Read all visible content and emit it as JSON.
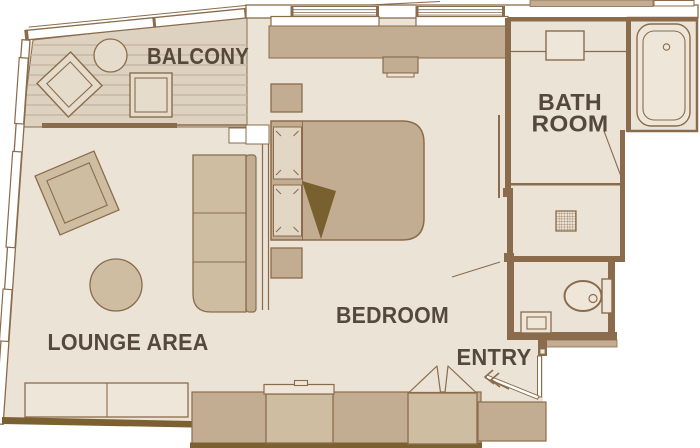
{
  "title": "Suite floor plan",
  "labels": {
    "balcony": "BALCONY",
    "bath_line1": "BATH",
    "bath_line2": "ROOM",
    "bedroom": "BEDROOM",
    "lounge": "LOUNGE AREA",
    "entry": "ENTRY"
  },
  "rooms": [
    {
      "id": "balcony",
      "label": "BALCONY"
    },
    {
      "id": "bathroom",
      "label": "BATH ROOM"
    },
    {
      "id": "bedroom",
      "label": "BEDROOM"
    },
    {
      "id": "lounge",
      "label": "LOUNGE AREA"
    },
    {
      "id": "entry",
      "label": "ENTRY"
    }
  ],
  "palette": {
    "bg": "#ffffff",
    "floor": "#ebe3d6",
    "balcony_floor": "#ddd2c0",
    "plank_line": "#c6b8a2",
    "tan": "#c3ad92",
    "furniture": "#cfbda2",
    "balcony_furniture": "#e6dccb",
    "fixture": "#eee6d9",
    "pillow": "#e2d7c4",
    "outline": "#8a6c4c",
    "dark_edge": "#7b6132",
    "blanket": "#79602f",
    "ink": "#55493c"
  }
}
